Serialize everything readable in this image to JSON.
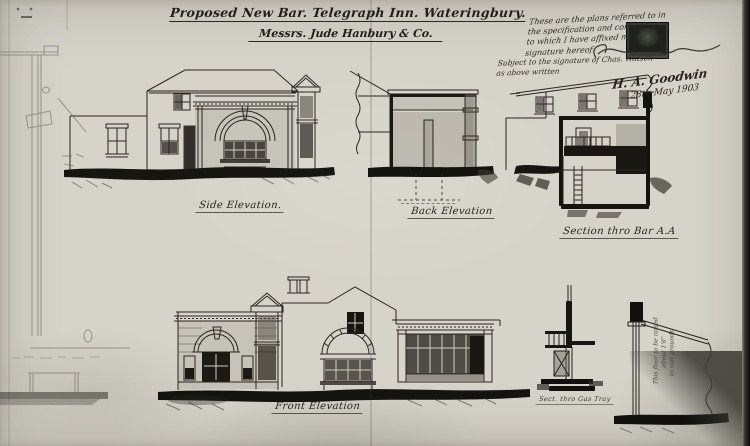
{
  "page": {
    "title_line1": "Proposed New Bar. Telegraph Inn. Wateringbury.",
    "title_line2": "Messrs. Jude Hanbury & Co.",
    "approval_note_lines": [
      "These are the plans referred to in",
      "the specification and conditions",
      "to which I have affixed my",
      "signature hereof"
    ],
    "condition_note_lines": [
      "Subject to the signature of Chas. Watson",
      "as above written"
    ],
    "signature_name": "H. A. Goodwin",
    "signature_date": "28th May 1903",
    "labels": {
      "side": "Side Elevation.",
      "back": "Back Elevation",
      "section": "Section thro Bar A.A",
      "front": "Front Elevation",
      "gas_tray": "Sect. thro Gas Tray"
    },
    "fence_note_lines": [
      "This floor to be raised",
      "about 1'6\"",
      "to suit grounds"
    ],
    "colors": {
      "paper": "#d6d3ca",
      "ink": "#221f1a",
      "wash": "#9a968c",
      "scan_edge": "#0c0c0a",
      "stamp": "#1f211c"
    }
  }
}
